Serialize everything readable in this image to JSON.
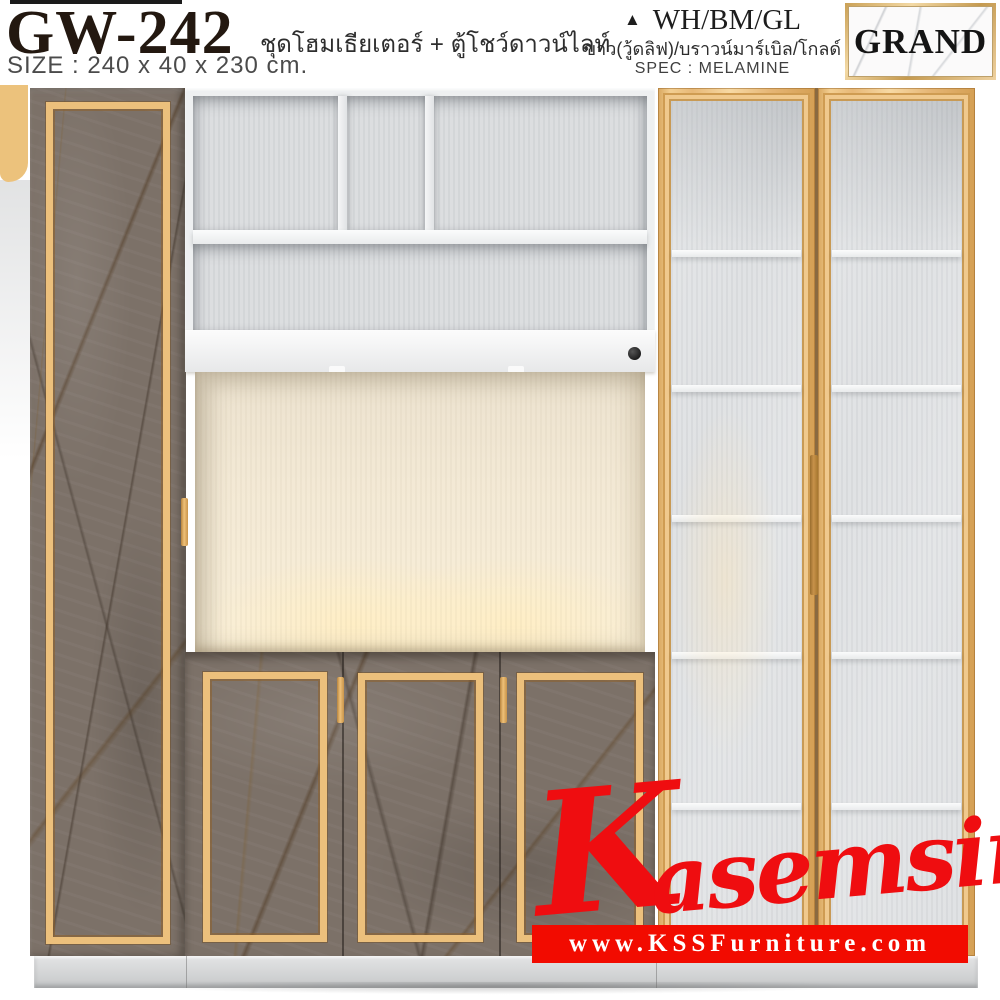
{
  "header": {
    "model": "GW-242",
    "subtitle_th": "ชุดโฮมเธียเตอร์ + ตู้โชว์ดาวน์ไลท์",
    "size_label": "SIZE : 240 x 40 x 230 cm.",
    "finish": {
      "triangle": "▲",
      "code": "WH/BM/GL",
      "desc_th": "ขาว(วู้ดลิฟ)/บราวน์มาร์เบิล/โกลด์",
      "spec": "SPEC : MELAMINE"
    },
    "brand": "GRAND"
  },
  "watermark": {
    "brand_initial": "K",
    "brand_rest": "asemsiri",
    "url": "www.KSSFurniture.com"
  },
  "colors": {
    "accent_gold": "#ecc07c",
    "marble_brown": "#7c7168",
    "brand_red": "#ef0d10",
    "banner_red": "#f20b00",
    "title_dark": "#231810",
    "interior_gray": "#dcdee0",
    "niche_warm": "#f9efd9",
    "plinth_gray": "#cfd1d2"
  }
}
